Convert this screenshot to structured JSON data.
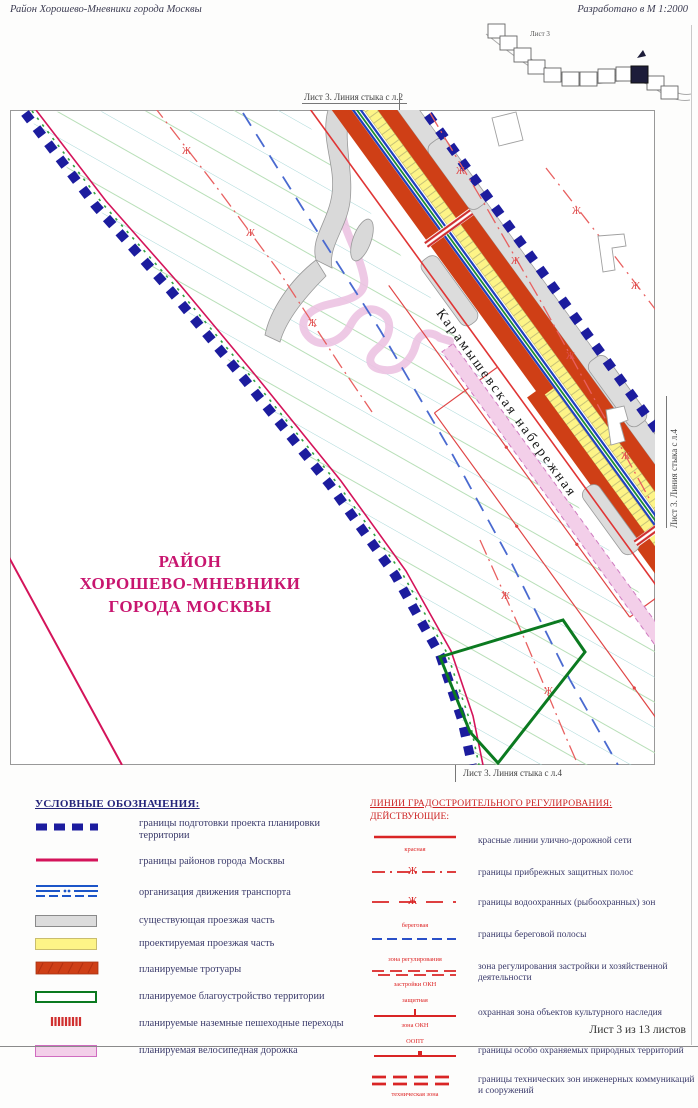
{
  "header": {
    "left_title": "Район Хорошево-Мневники города Москвы",
    "right_title": "Разработано в М 1:2000"
  },
  "inset": {
    "sheet_label": "Лист 3"
  },
  "map": {
    "edge_label_top": "Лист 3. Линия стыка с л.2",
    "edge_label_right": "Лист 3. Линия стыка с л.4",
    "edge_label_bottom": "Лист 3. Линия стыка с л.4",
    "street_label": "Карамышевская набережная",
    "district_title_line1": "РАЙОН",
    "district_title_line2": "ХОРОШЕВО-МНЕВНИКИ",
    "district_title_line3": "ГОРОДА МОСКВЫ"
  },
  "legend_left": {
    "title": "УСЛОВНЫЕ ОБОЗНАЧЕНИЯ:",
    "items": [
      {
        "label": "границы подготовки проекта планировки территории"
      },
      {
        "label": "границы районов города Москвы"
      },
      {
        "label": "организация движения транспорта"
      },
      {
        "label": "существующая проезжая часть"
      },
      {
        "label": "проектируемая проезжая часть"
      },
      {
        "label": "планируемые тротуары"
      },
      {
        "label": "планируемое благоустройство территории"
      },
      {
        "label": "планируемые наземные пешеходные переходы"
      },
      {
        "label": "планируемая велосипедная дорожка"
      }
    ]
  },
  "legend_right": {
    "title": "ЛИНИИ ГРАДОСТРОИТЕЛЬНОГО РЕГУЛИРОВАНИЯ:",
    "subtitle": "ДЕЙСТВУЮЩИЕ:",
    "items": [
      {
        "label": "красные линии улично-дорожной сети",
        "note_below": "красная"
      },
      {
        "label": "границы прибрежных защитных полос",
        "glyph": "Ж"
      },
      {
        "label": "границы водоохранных (рыбоохранных) зон",
        "glyph": "Ж"
      },
      {
        "label": "границы береговой полосы",
        "note_above": "береговая"
      },
      {
        "label": "зона регулирования застройки и хозяйственной деятельности",
        "note_above": "зона регулирования",
        "note_below": "застройки ОКН"
      },
      {
        "label": "охранная зона объектов культурного наследия",
        "note_above": "защитная",
        "note_below": "зона ОКН"
      },
      {
        "label": "границы особо охраняемых природных территорий",
        "note_above": "ООПТ"
      },
      {
        "label": "границы технических зон инженерных коммуникаций и сооружений",
        "note_below": "техническая зона"
      }
    ]
  },
  "footer": {
    "sheet_info": "Лист 3 из 13 листов"
  },
  "colors": {
    "boundary_blue": "#1c1c9e",
    "district_crimson": "#d4145a",
    "red_line": "#e03535",
    "sidewalk_orange": "#cf3f16",
    "roadway_yellow": "#fdf487",
    "roadway_gray": "#dcdcdc",
    "greenery_green": "#0b7a20",
    "bike_pink": "#f3cfe9",
    "title_magenta": "#c8156f"
  }
}
